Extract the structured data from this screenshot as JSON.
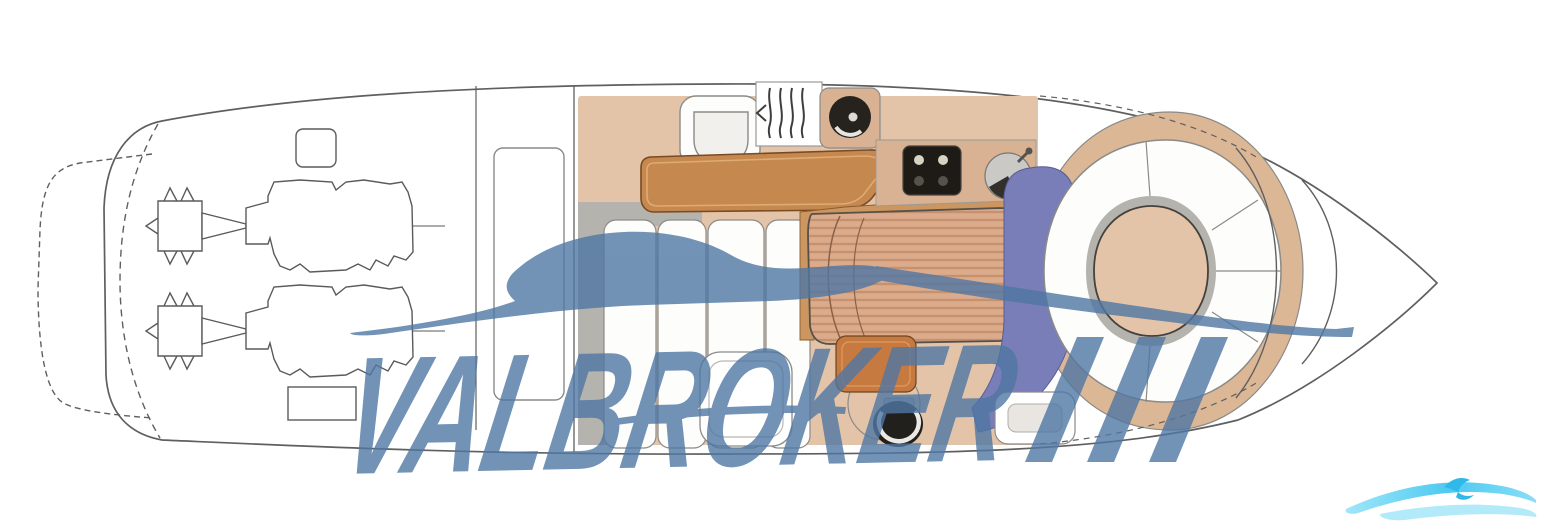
{
  "watermark": {
    "brand": "VALBROKER",
    "slashes": "///"
  },
  "colors": {
    "watermark_blue": "#4f77a4",
    "wave_cyan": "#4cc9f0",
    "wave_cyan_light": "#aee9fa",
    "hull_line": "#5f5f5f",
    "cabin_tan": "#e4c4a9",
    "counter_tan": "#d8b292",
    "bow_tan": "#dcb795",
    "wood": "#c5894f",
    "wood_light": "#cc9660",
    "bed": "#dcab8b",
    "bed_stripe": "#c5916f",
    "carpet_purple": "#7a7eb8",
    "trim_gray": "#b5b3ae",
    "stove_black": "#1e1b17",
    "vanity_orange": "#c77a3f"
  }
}
